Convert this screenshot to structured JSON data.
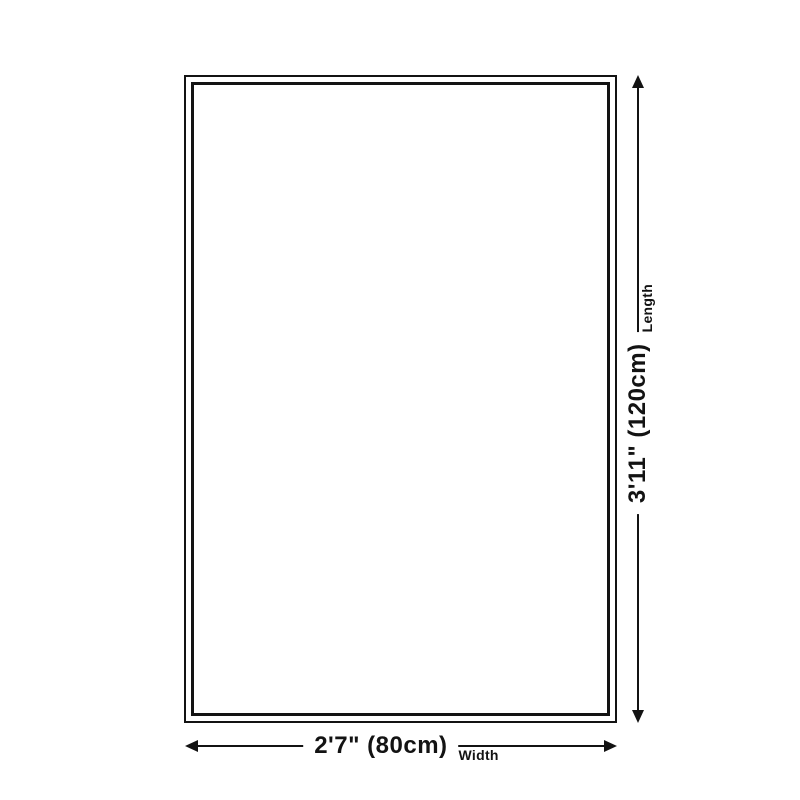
{
  "diagram": {
    "kind": "rug-size-diagram",
    "colors": {
      "background": "#ffffff",
      "line": "#131313",
      "rug_fill": "#ffffff"
    },
    "length_dimension": {
      "value": "3'11\" (120cm)",
      "label": "Length",
      "icons": [
        "arrow-up-icon",
        "arrow-down-icon"
      ]
    },
    "width_dimension": {
      "value": "2'7\" (80cm)",
      "label": "Width",
      "icons": [
        "arrow-left-icon",
        "arrow-right-icon"
      ]
    }
  }
}
